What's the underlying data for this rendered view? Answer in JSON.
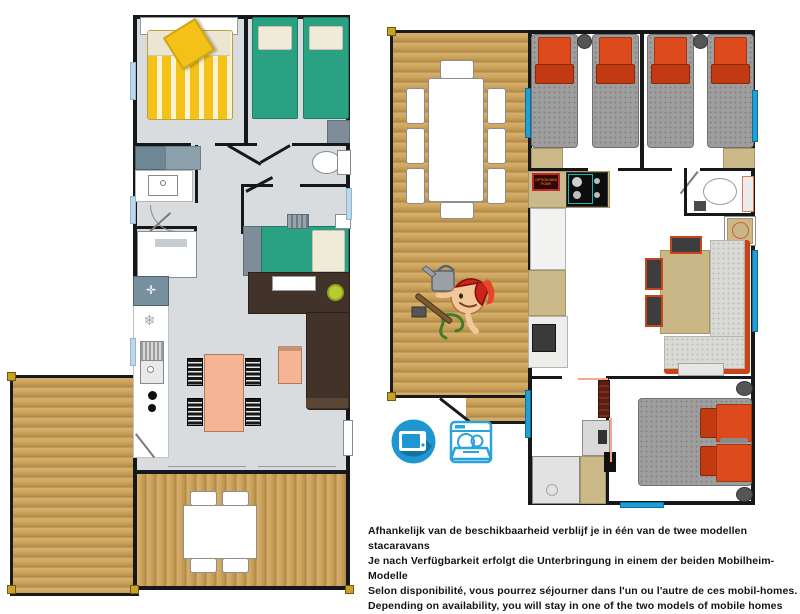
{
  "caption": {
    "lines": [
      "Afhankelijk van de beschikbaarheid verblijf je in één van de twee modellen stacaravans",
      "Je nach Verfügbarkeit erfolgt die Unterbringung in einem der beiden Mobilheim-Modelle",
      "Selon disponibilité, vous pourrez séjourner dans l'un ou l'autre de ces mobil-homes.",
      "Depending on availability, you will stay in one of the two models of mobile homes"
    ]
  },
  "labels": {
    "option_plaque": "OPTION MINI FOUR"
  },
  "icons": [
    {
      "name": "tv-icon"
    },
    {
      "name": "dishwasher-icon"
    }
  ],
  "palette": {
    "wall": "#15181a",
    "wood": "#cda45e",
    "floor_gray": "#d9dcde",
    "bed_green": "#2aa183",
    "bed_yellow": "#f3c117",
    "pillow_orange": "#dd4b1c",
    "sofa_brown": "#42332a",
    "table_peach": "#f5b595",
    "window_light_blue": "#bcd9e8",
    "window_bright_blue": "#1f9fd6",
    "icon_blue": "#1d96d2",
    "accent_lime": "#b5cd30"
  }
}
